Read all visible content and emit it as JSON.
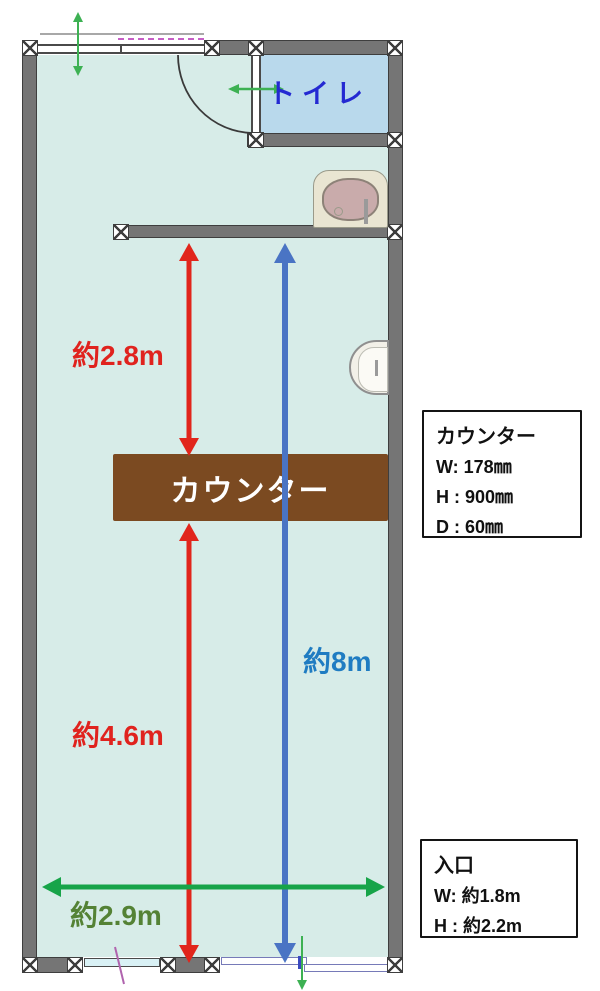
{
  "labels": {
    "toilet": "トイレ",
    "counter": "カウンター"
  },
  "dimensions": {
    "red_upper": "約2.8m",
    "red_lower": "約4.6m",
    "blue_full": "約8m",
    "green_width": "約2.9m"
  },
  "callouts": {
    "counter": {
      "title": "カウンター",
      "rows": [
        "W: 178㎜",
        "H : 900㎜",
        "D : 60㎜"
      ]
    },
    "entrance": {
      "title": "入口",
      "rows": [
        "W: 約1.8m",
        "H : 約2.2m"
      ]
    }
  },
  "colors": {
    "red_arrow": "#e1251b",
    "blue_arrow": "#4a74c4",
    "blue_text": "#1f7cc2",
    "green_arrow": "#17a449",
    "green_text": "#548235",
    "counter_fill": "#7b4a21",
    "room_fill": "#d7ece8",
    "toilet_fill": "#b9d9ec",
    "wall_gray": "#757575",
    "toilet_text": "#2429d2"
  }
}
